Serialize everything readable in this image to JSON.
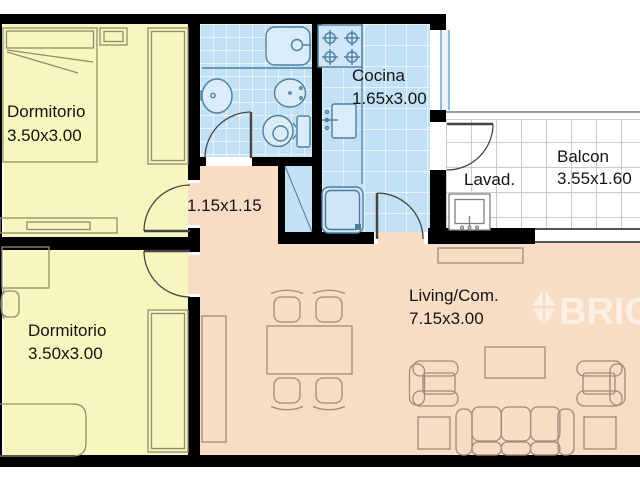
{
  "title": "Apartment floor plan",
  "rooms": {
    "bedroom_top": {
      "label": "Dormitorio",
      "dims": "3.50x3.00"
    },
    "bedroom_bottom": {
      "label": "Dormitorio",
      "dims": "3.50x3.00"
    },
    "kitchen": {
      "label": "Cocina",
      "dims": "1.65x3.00"
    },
    "hall": {
      "dims": "1.15x1.15"
    },
    "laundry": {
      "label": "Lavad."
    },
    "balcony": {
      "label": "Balcon",
      "dims": "3.55x1.60"
    },
    "living": {
      "label": "Living/Com.",
      "dims": "7.15x3.00"
    }
  },
  "watermark": {
    "text": "BRICK",
    "logo_icon": "diamond-gem-icon"
  },
  "colors": {
    "bedroom_floor": "#F6F6BE",
    "wet_room_floor": "#C3E1F4",
    "living_floor": "#F8DCC3",
    "wall": "#000000",
    "balcony_tile_line": "#CBCBCB",
    "fixture_outline": "#4E7E9E",
    "bedroom_furniture_outline": "#8F8F6E",
    "living_furniture_outline": "#A3897A",
    "watermark_color": "#FFFFFF"
  },
  "fixtures": {
    "bathroom": [
      "bathtub",
      "shower-tray",
      "washbasin",
      "bidet",
      "toilet"
    ],
    "kitchen": [
      "stove",
      "counter",
      "kitchen-sink",
      "refrigerator"
    ],
    "laundry": [
      "laundry-sink"
    ],
    "bedroom_top": [
      "double-bed",
      "nightstand",
      "wardrobe",
      "dresser"
    ],
    "bedroom_bottom": [
      "desk",
      "desk-chair",
      "bed",
      "wardrobe"
    ],
    "living": [
      "shelf-unit",
      "dining-table",
      "dining-chairs",
      "sideboard",
      "coffee-table",
      "armchairs",
      "sofa",
      "side-tables"
    ],
    "shaft": [
      "vent-shaft"
    ]
  }
}
